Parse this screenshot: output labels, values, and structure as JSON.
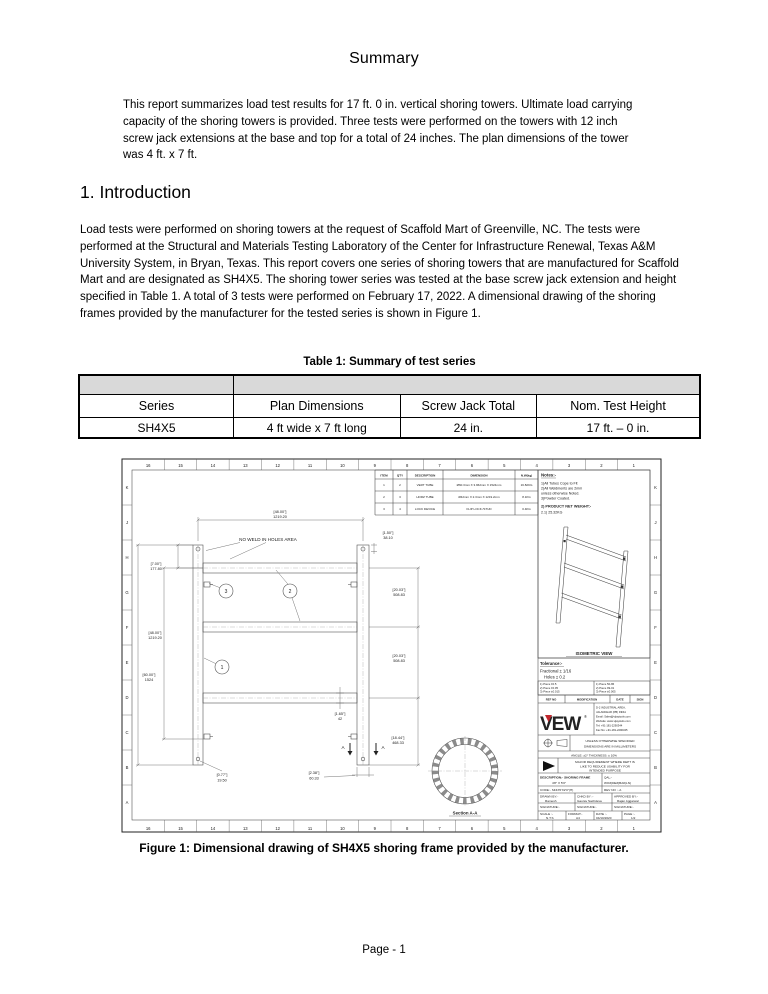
{
  "accent_red": "#c1272d",
  "summary": {
    "title": "Summary",
    "body": "This report summarizes load test results for 17 ft. 0 in. vertical shoring towers.  Ultimate load carrying capacity of the shoring towers is provided.  Three tests were performed on the towers with 12 inch screw jack extensions at the base and top for a total of 24 inches.  The plan dimensions of the tower was 4 ft. x 7 ft."
  },
  "introduction": {
    "heading": "1. Introduction",
    "body": "Load tests were performed on shoring towers at the request of Scaffold Mart of Greenville, NC.  The tests were performed at the Structural and Materials Testing Laboratory of the Center for Infrastructure Renewal, Texas A&M University System, in Bryan, Texas.  This report covers one series of shoring towers that are manufactured for Scaffold Mart and are designated as SH4X5.  The shoring tower series was tested at the base screw jack extension and height specified in Table 1.  A total of 3 tests were performed on February 17, 2022.  A dimensional drawing of the shoring frames provided by the manufacturer for the tested series is shown in Figure 1."
  },
  "table1": {
    "caption": "Table 1: Summary of test series",
    "header_fill": "#d9d9d9",
    "headers": [
      "Series",
      "Plan Dimensions",
      "Screw Jack Total",
      "Nom. Test Height"
    ],
    "rows": [
      [
        "SH4X5",
        "4 ft wide x 7 ft long",
        "24 in.",
        "17 ft. – 0 in."
      ]
    ]
  },
  "figure": {
    "caption": "Figure 1: Dimensional drawing of SH4X5 shoring frame provided by the manufacturer.",
    "grid": {
      "columns": [
        "16",
        "15",
        "14",
        "13",
        "12",
        "11",
        "10",
        "9",
        "8",
        "7",
        "6",
        "5",
        "4",
        "3",
        "2",
        "1"
      ],
      "rows": [
        "K",
        "J",
        "H",
        "G",
        "F",
        "E",
        "D",
        "C",
        "B",
        "A"
      ]
    },
    "bom": {
      "headers": [
        "ITEM",
        "QTY",
        "DESCRIPTION",
        "DIMENSION",
        "N.W(kg)"
      ],
      "rows": [
        [
          "1",
          "2",
          "VERT TUBE",
          "Ø60.3mm X 3.962mm X 1524mm",
          "16.82KG"
        ],
        [
          "2",
          "3",
          "HORZ TUBE",
          "Ø42mm X 2.3mm X 1219.2mm",
          "8.1KG"
        ],
        [
          "3",
          "4",
          "LOCK DEVICE",
          "FLIP LOCK /STUD",
          "0.4KG"
        ]
      ]
    },
    "notes": {
      "title": "Notes:-",
      "lines": [
        "1)All Tubes Cope to Fit",
        "2)All Weldments are 2mm",
        "unless otherwise Noted.",
        "3)Powder Coated."
      ],
      "weight_title": "2) PRODUCT NET WEIGHT:-",
      "weight_value": "2.1) 25.32KG"
    },
    "iso_label": "ISOMETRIC VIEW",
    "tolerance": {
      "title": "Tolerance:-",
      "lines": [
        "Fractional ± 1/16",
        "Holes ± 0.2"
      ],
      "table_left": [
        "1) Piece ±0.5",
        "2) Piece ±0.05",
        "3) Piece ±0.015"
      ],
      "table_right": [
        "1) Piece 50-86",
        "2) Piece 99-01",
        "3) Piece ±0.005"
      ],
      "ref_headers": [
        "REF NO",
        "MODIFICATION",
        "DATE",
        "SIGN"
      ]
    },
    "brand": {
      "logo": "VEW",
      "reg": "®",
      "address_lines": [
        "D-2 INDUSTRIAL AREA,",
        "JALANDHAR (PB) INDIA",
        "Email: Sales@vijaytools.com",
        "Website: www.vijaytools.com",
        "Tel: +91-181-2290344",
        "Fax No: +91-181-2290345"
      ]
    },
    "units_note": [
      "UNLESS OTHERWISE SPECIFIED",
      "DIMENSIONS ARE IN MILLIMETERS"
    ],
    "angle_note": "ANGLE: ±2°    THICKNESS: ± 10%",
    "major_note": [
      "MAJOR REQUIREMENT WHERE DEPT IS",
      "LIKE TO REDUCE USABILITY FOR",
      "INTENDED PURPOSE"
    ],
    "title_block": {
      "description_label": "DESCRIPTION:- SHORING FRAME",
      "description_value": "4'8\" X 5'0\"",
      "qal_label": "QAL:-",
      "qal_value": "WO#(DE#)BA#(LN)",
      "code": "CODE:- SF4X5'X2'0\"(H)",
      "rev": "REV NO :- A",
      "drawn_label": "DRAWN BY:-",
      "drawn_name": "Ramesh",
      "chkd_label": "CHKD BY :-",
      "chkd_name": "Gaurav Sachdeva",
      "approved_label": "APPROVED BY:-",
      "approved_name": "Rajan Aggarwal",
      "sign": "SIGNATURE:-",
      "scale_label": "SCALE :-",
      "scale_value": "N.T.S",
      "format_label": "FORMAT:-",
      "format_value": "A4",
      "date_label": "DATE :-",
      "date_value": "04/10/2020",
      "page_label": "PAGE :-",
      "page_value": "1/2"
    },
    "annotations": {
      "no_weld": "NO WELD IN HOLES AREA",
      "section_label": "Section A-A",
      "section_letter": "A",
      "balloons": [
        "1",
        "2",
        "3"
      ]
    },
    "dims": {
      "width_top": {
        "in": "[48.00\"]",
        "mm": "1219.20"
      },
      "offset_top_right": {
        "in": "[1.50\"]",
        "mm": "38.10"
      },
      "top_to_first": {
        "in": "[7.00\"]",
        "mm": "177.80"
      },
      "rung_span_left": {
        "in": "[48.00\"]",
        "mm": "1219.20"
      },
      "full_height": {
        "in": "[60.00\"]",
        "mm": "1524"
      },
      "rung_gap_1": {
        "in": "[20.03\"]",
        "mm": "508.83"
      },
      "rung_gap_2": {
        "in": "[20.03\"]",
        "mm": "508.83"
      },
      "bottom_ext": {
        "in": "[18.44\"]",
        "mm": "468.33"
      },
      "horz_od": {
        "in": "[1.65\"]",
        "mm": "42"
      },
      "vert_od": {
        "in": "[2.38\"]",
        "mm": "60.33"
      },
      "hole_dia": {
        "in": "[0.77\"]",
        "mm": "19.50"
      }
    }
  },
  "footer": "Page - 1"
}
